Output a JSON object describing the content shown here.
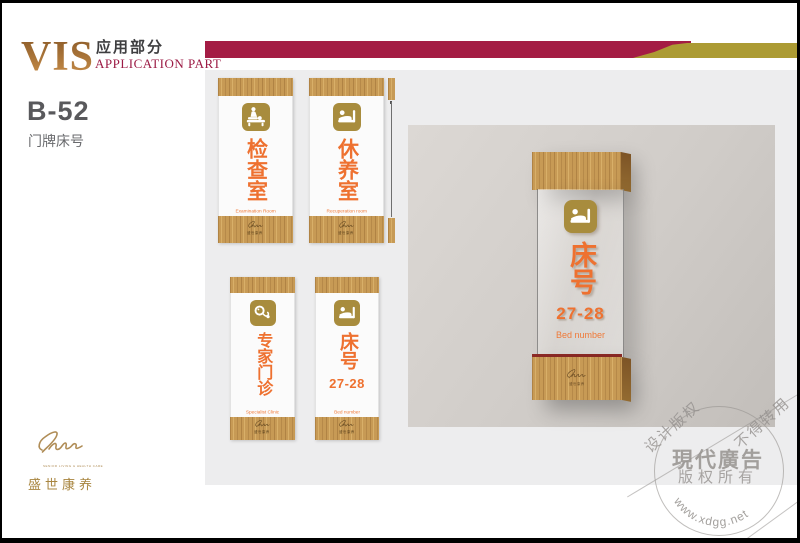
{
  "header": {
    "logo": "VIS",
    "section_cn": "应用部分",
    "section_en": "APPLICATION PART"
  },
  "item": {
    "code": "B-52",
    "name": "门牌床号"
  },
  "brand": {
    "name_cn": "盛世康养",
    "tagline": "SENIOR LIVING & HEALTH CARE"
  },
  "signs": [
    {
      "title": "检查室",
      "subtitle": "Examination Room",
      "icon": "exam-table-icon"
    },
    {
      "title": "休养室",
      "subtitle": "Recuperation room",
      "icon": "patient-bed-icon"
    },
    {
      "title": "专家门诊",
      "subtitle": "Specialist Clinic",
      "icon": "stethoscope-icon"
    },
    {
      "title": "床号",
      "number": "27-28",
      "subtitle": "Bed number",
      "icon": "patient-bed-icon"
    }
  ],
  "render": {
    "title": "床号",
    "number": "27-28",
    "subtitle": "Bed number",
    "icon": "patient-bed-icon"
  },
  "watermark": {
    "diag1": "设计版权",
    "diag2": "不得转用",
    "title": "現代廣告",
    "subtitle": "版权所有",
    "url": "www.xdgg.net"
  },
  "colors": {
    "accent_red": "#a41c44",
    "accent_gold": "#ac9b34",
    "icon_gold": "#a88c3d",
    "text_orange": "#ee7130",
    "wood": "#c79a55",
    "panel_gray": "#ededee",
    "wall_gray": "#d0ccc8"
  }
}
